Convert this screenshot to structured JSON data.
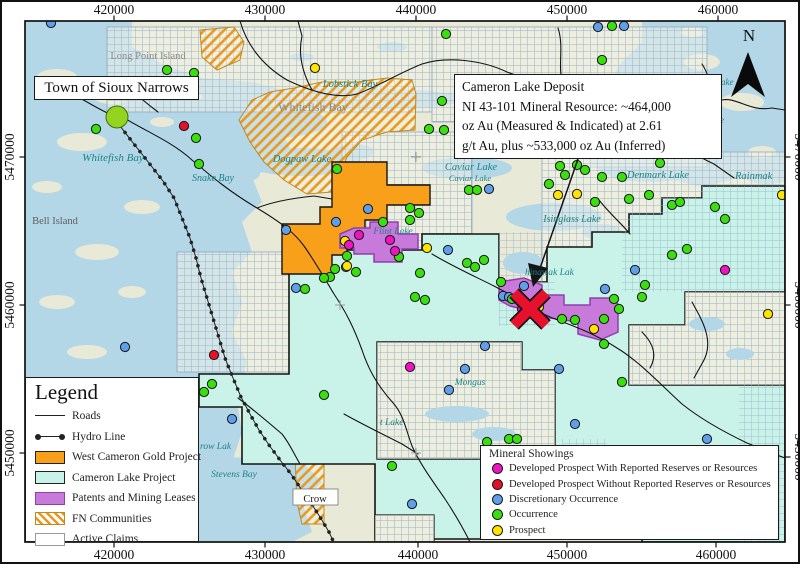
{
  "colors": {
    "water": "#b4d7e8",
    "land": "#e8e9d6",
    "cameron_lake_project": "#c9f3e9",
    "west_cameron_gold_project": "#f9a01b",
    "patents_mining_leases": "#c77ad9",
    "fn_hatch": "#e8991d",
    "occurrence": "#39e00e",
    "discretionary_occurrence": "#5f9fe8",
    "prospect": "#ffe400",
    "developed_with": "#f013c0",
    "developed_without": "#e31227",
    "deposit_x": "#e8112d"
  },
  "annotations": {
    "town_box": {
      "text": "Town of Sioux Narrows"
    },
    "callout": {
      "lines": [
        "Cameron Lake Deposit",
        "NI 43-101 Mineral Resource: ~464,000",
        "oz Au (Measured & Indicated) at 2.61",
        "g/t Au, plus ~533,000 oz Au (Inferred)"
      ]
    },
    "north_label": "N"
  },
  "legend": {
    "title": "Legend",
    "items": [
      {
        "symbol": "road",
        "label": "Roads"
      },
      {
        "symbol": "hydro",
        "label": "Hydro Line"
      },
      {
        "symbol": "orange",
        "label": "West Cameron Gold Project"
      },
      {
        "symbol": "cyan",
        "label": "Cameron Lake Project"
      },
      {
        "symbol": "purple",
        "label": "Patents and Mining Leases"
      },
      {
        "symbol": "hatch",
        "label": "FN Communities"
      },
      {
        "symbol": "white",
        "label": "Active Claims"
      }
    ]
  },
  "showings_legend": {
    "title": "Mineral Showings",
    "items": [
      {
        "color": "#f013c0",
        "label": "Developed Prospect With Reported Reserves or Resources"
      },
      {
        "color": "#e31227",
        "label": "Developed Prospect Without Reported Reserves or Resources"
      },
      {
        "color": "#5f9fe8",
        "label": "Discretionary Occurrence"
      },
      {
        "color": "#39e00e",
        "label": "Occurrence"
      },
      {
        "color": "#ffe400",
        "label": "Prospect"
      }
    ]
  },
  "map": {
    "axis": {
      "top": [
        {
          "label": "420000",
          "x": 112
        },
        {
          "label": "430000",
          "x": 263
        },
        {
          "label": "440000",
          "x": 414
        },
        {
          "label": "450000",
          "x": 565
        },
        {
          "label": "460000",
          "x": 716
        }
      ],
      "bottom": [
        {
          "label": "420000",
          "x": 112
        },
        {
          "label": "430000",
          "x": 263
        },
        {
          "label": "440000",
          "x": 416
        },
        {
          "label": "450000",
          "x": 565
        },
        {
          "label": "460000",
          "x": 714
        }
      ],
      "left": [
        {
          "label": "5470000",
          "y": 155
        },
        {
          "label": "5460000",
          "y": 303
        },
        {
          "label": "5450000",
          "y": 451
        }
      ],
      "right": [
        {
          "label": "5470000",
          "y": 155
        },
        {
          "label": "5460000",
          "y": 303
        },
        {
          "label": "5450000",
          "y": 455
        }
      ]
    },
    "labels": [
      {
        "text": "Long Point Island",
        "x": 146,
        "y": 57,
        "cls": "gray",
        "size": 10.5,
        "a": "m"
      },
      {
        "text": "Whitefish Bay",
        "x": 111,
        "y": 159,
        "cls": "teal",
        "size": 11,
        "a": "m"
      },
      {
        "text": "Whitefish Bay",
        "x": 311,
        "y": 109,
        "cls": "gray",
        "size": 12,
        "a": "m"
      },
      {
        "text": "Lobstick Bay",
        "x": 348,
        "y": 85,
        "cls": "teal",
        "size": 10.5,
        "a": "m"
      },
      {
        "text": "Dogpaw Lake",
        "x": 300,
        "y": 160,
        "cls": "teal",
        "size": 10.5,
        "a": "m"
      },
      {
        "text": "Snake Bay",
        "x": 211,
        "y": 179,
        "cls": "teal",
        "size": 10,
        "a": "m"
      },
      {
        "text": "Bell Island",
        "x": 53,
        "y": 222,
        "cls": "gray2",
        "size": 10.5,
        "a": "m"
      },
      {
        "text": "Caviar Lake",
        "x": 469,
        "y": 168,
        "cls": "teal",
        "size": 10.5,
        "a": "m"
      },
      {
        "text": "Caviar Lake",
        "x": 468,
        "y": 179,
        "cls": "teal",
        "size": 8.5,
        "a": "m"
      },
      {
        "text": "Denmark Lake",
        "x": 656,
        "y": 176,
        "cls": "teal",
        "size": 10.5,
        "a": "m"
      },
      {
        "text": "Rainmak",
        "x": 733,
        "y": 177,
        "cls": "teal",
        "size": 10.5,
        "a": "s"
      },
      {
        "text": "Isinglass Lake",
        "x": 570,
        "y": 220,
        "cls": "teal",
        "size": 10,
        "a": "m"
      },
      {
        "text": "Flint Lake",
        "x": 391,
        "y": 232,
        "cls": "teal",
        "size": 9.5,
        "a": "m"
      },
      {
        "text": "hinawak Lak",
        "x": 523,
        "y": 273,
        "cls": "teal",
        "size": 9.5,
        "a": "s"
      },
      {
        "text": "Mongus",
        "x": 468,
        "y": 383,
        "cls": "teal",
        "size": 9.5,
        "a": "m"
      },
      {
        "text": "t Lake",
        "x": 378,
        "y": 423,
        "cls": "teal",
        "size": 9.5,
        "a": "s"
      },
      {
        "text": "row Lak",
        "x": 198,
        "y": 447,
        "cls": "teal",
        "size": 9.5,
        "a": "s"
      },
      {
        "text": "Stevens Bay",
        "x": 232,
        "y": 475,
        "cls": "teal",
        "size": 9.5,
        "a": "m"
      },
      {
        "text": "ake",
        "x": 719,
        "y": 83,
        "cls": "teal",
        "size": 9,
        "a": "s"
      },
      {
        "text": "ke",
        "x": 714,
        "y": 121,
        "cls": "teal",
        "size": 9,
        "a": "s"
      },
      {
        "text": "Crow",
        "x": 313,
        "y": 500,
        "cls": "dark",
        "size": 10.5,
        "a": "m"
      }
    ],
    "showings": [
      {
        "id": "discretionary-occurrence",
        "color": "#5f9fe8",
        "points": [
          [
            49,
            21
          ],
          [
            596,
            25
          ],
          [
            622,
            24
          ],
          [
            334,
            220
          ],
          [
            366,
            207
          ],
          [
            284,
            228
          ],
          [
            446,
            248
          ],
          [
            501,
            294
          ],
          [
            522,
            284
          ],
          [
            507,
            295
          ],
          [
            483,
            344
          ],
          [
            603,
            287
          ],
          [
            487,
            187
          ],
          [
            230,
            417
          ],
          [
            410,
            502
          ],
          [
            573,
            422
          ],
          [
            557,
            367
          ],
          [
            463,
            367
          ],
          [
            447,
            388
          ],
          [
            705,
            437
          ],
          [
            294,
            286
          ],
          [
            123,
            345
          ],
          [
            633,
            268
          ]
        ]
      },
      {
        "id": "occurrence",
        "color": "#39e00e",
        "points": [
          [
            165,
            68
          ],
          [
            192,
            71
          ],
          [
            94,
            127
          ],
          [
            194,
            136
          ],
          [
            197,
            162
          ],
          [
            444,
            32
          ],
          [
            610,
            24
          ],
          [
            600,
            58
          ],
          [
            440,
            99
          ],
          [
            427,
            127
          ],
          [
            442,
            128
          ],
          [
            335,
            167
          ],
          [
            408,
            206
          ],
          [
            417,
            211
          ],
          [
            408,
            218
          ],
          [
            381,
            220
          ],
          [
            397,
            255
          ],
          [
            345,
            254
          ],
          [
            344,
            265
          ],
          [
            333,
            267
          ],
          [
            328,
            275
          ],
          [
            322,
            276
          ],
          [
            354,
            270
          ],
          [
            303,
            287
          ],
          [
            418,
            271
          ],
          [
            413,
            295
          ],
          [
            423,
            298
          ],
          [
            465,
            261
          ],
          [
            482,
            258
          ],
          [
            473,
            265
          ],
          [
            499,
            280
          ],
          [
            510,
            297
          ],
          [
            560,
            317
          ],
          [
            573,
            318
          ],
          [
            602,
            317
          ],
          [
            612,
            297
          ],
          [
            617,
            307
          ],
          [
            643,
            283
          ],
          [
            670,
            253
          ],
          [
            685,
            247
          ],
          [
            575,
            163
          ],
          [
            583,
            168
          ],
          [
            620,
            175
          ],
          [
            593,
            200
          ],
          [
            647,
            193
          ],
          [
            670,
            203
          ],
          [
            678,
            200
          ],
          [
            713,
            205
          ],
          [
            723,
            217
          ],
          [
            658,
            161
          ],
          [
            558,
            164
          ],
          [
            563,
            173
          ],
          [
            547,
            182
          ],
          [
            600,
            175
          ],
          [
            627,
            197
          ],
          [
            467,
            188
          ],
          [
            475,
            188
          ],
          [
            640,
            295
          ],
          [
            602,
            342
          ],
          [
            620,
            380
          ],
          [
            322,
            393
          ],
          [
            202,
            390
          ],
          [
            210,
            382
          ],
          [
            485,
            440
          ],
          [
            507,
            437
          ],
          [
            515,
            437
          ],
          [
            390,
            464
          ]
        ]
      },
      {
        "id": "prospect",
        "color": "#ffe400",
        "points": [
          [
            313,
            66
          ],
          [
            343,
            239
          ],
          [
            425,
            246
          ],
          [
            345,
            264
          ],
          [
            556,
            193
          ],
          [
            575,
            192
          ],
          [
            780,
            193
          ],
          [
            766,
            312
          ],
          [
            592,
            327
          ],
          [
            537,
            305
          ]
        ]
      },
      {
        "id": "developed-prospect-with-reserves",
        "color": "#f013c0",
        "points": [
          [
            357,
            233
          ],
          [
            388,
            238
          ],
          [
            347,
            243
          ],
          [
            393,
            249
          ],
          [
            520,
            307
          ],
          [
            408,
            365
          ],
          [
            723,
            268
          ]
        ]
      },
      {
        "id": "developed-prospect-without-reserves",
        "color": "#e31227",
        "points": [
          [
            182,
            124
          ],
          [
            212,
            353
          ]
        ]
      }
    ],
    "deposit_marker": {
      "x": 528,
      "y": 307
    },
    "town_marker": {
      "x": 115,
      "y": 115
    }
  }
}
